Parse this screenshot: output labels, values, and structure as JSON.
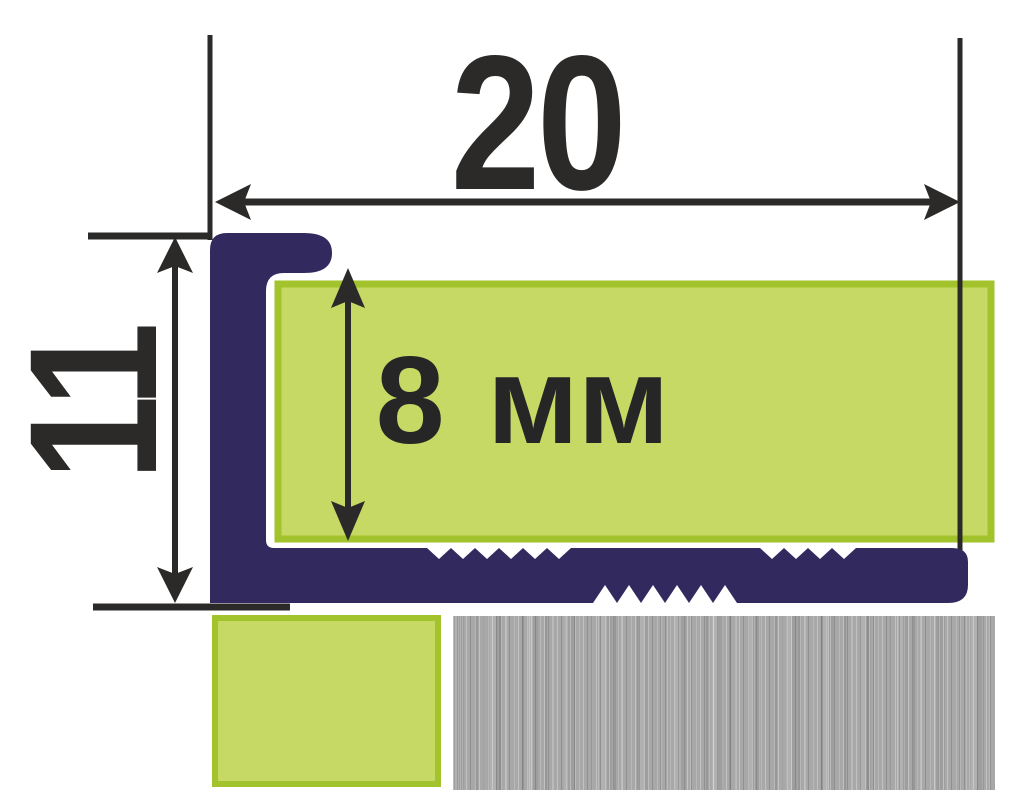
{
  "diagram": {
    "width_label": "20",
    "height_label": "11",
    "thickness_label": "8 мм"
  },
  "colors": {
    "navy": "#322a5f",
    "line": "#2b2a29",
    "text": "#262626",
    "green-fill": "#c6d965",
    "green-border": "#a2c32c",
    "metal-base": "#a8a8a8",
    "bg": "#ffffff"
  }
}
